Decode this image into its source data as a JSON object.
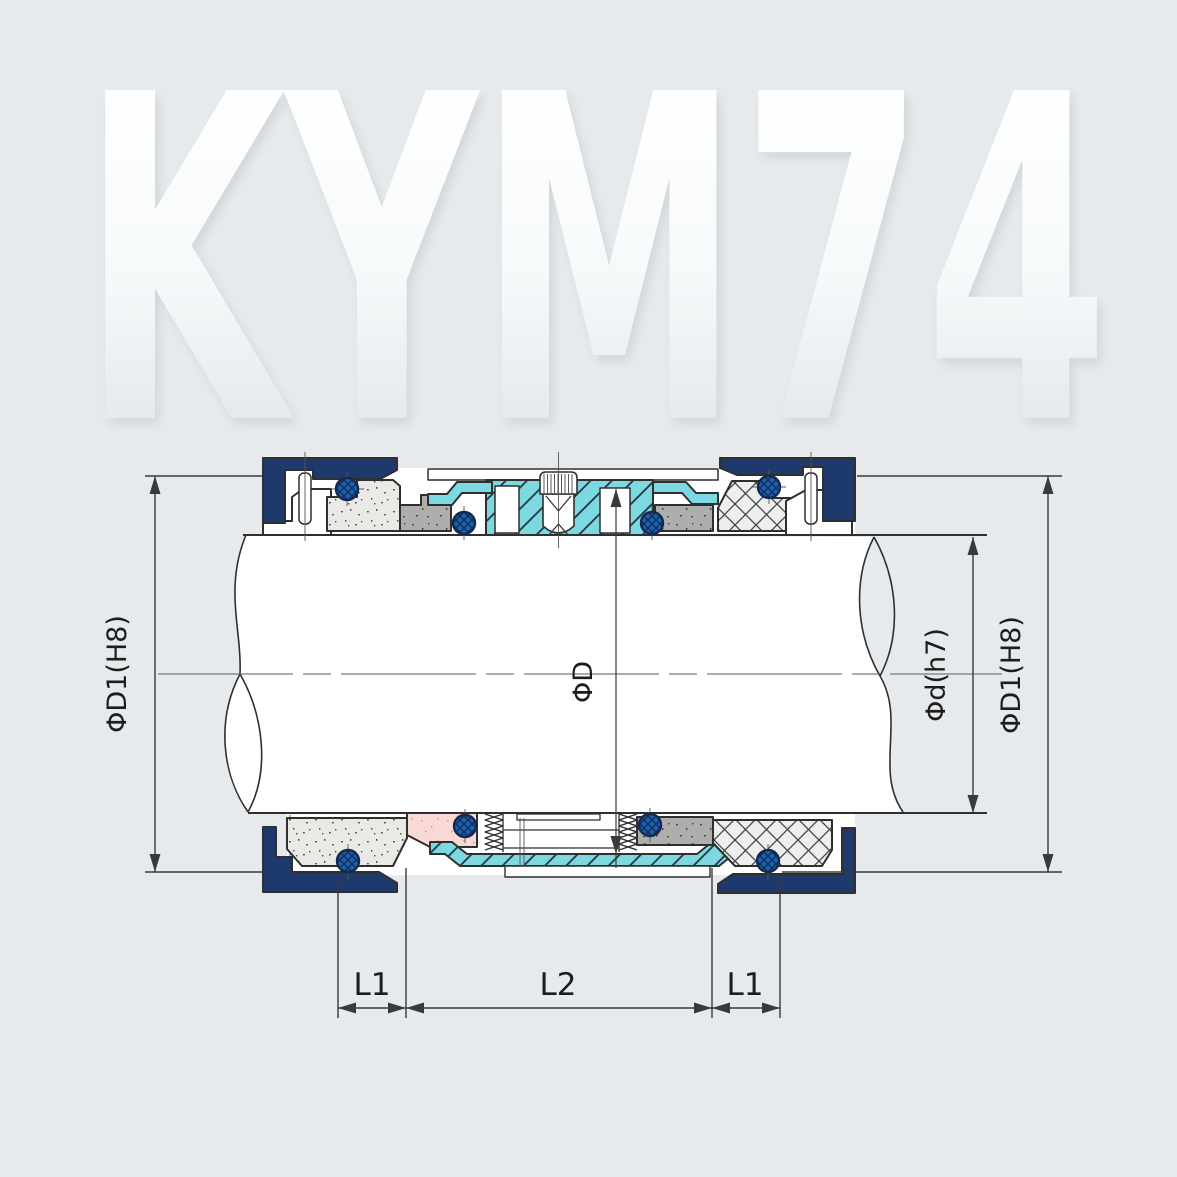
{
  "watermark": {
    "text": "KYM74"
  },
  "drawing": {
    "type": "technical-cross-section",
    "subject": "mechanical seal assembly on shaft",
    "labels": {
      "diameter_housing_left": "ΦD1(H8)",
      "diameter_seal": "ΦD",
      "diameter_shaft": "Φd(h7)",
      "diameter_housing_right": "ΦD1(H8)",
      "length_l1_left": "L1",
      "length_l2": "L2",
      "length_l1_right": "L1"
    },
    "colors": {
      "background": "#e6eaec",
      "navy": "#1e3a6c",
      "teal": "#7cd9e2",
      "oring_blue": "#1e5fae",
      "face_speckled": "#e9e9e5",
      "spacer_gray": "#aeaeac",
      "pink": "#f8d9d5",
      "outline": "#2f2f2f",
      "dimension": "#3a3a3a",
      "watermark_top": "#ffffff",
      "watermark_bottom": "#e3e8ea"
    }
  }
}
